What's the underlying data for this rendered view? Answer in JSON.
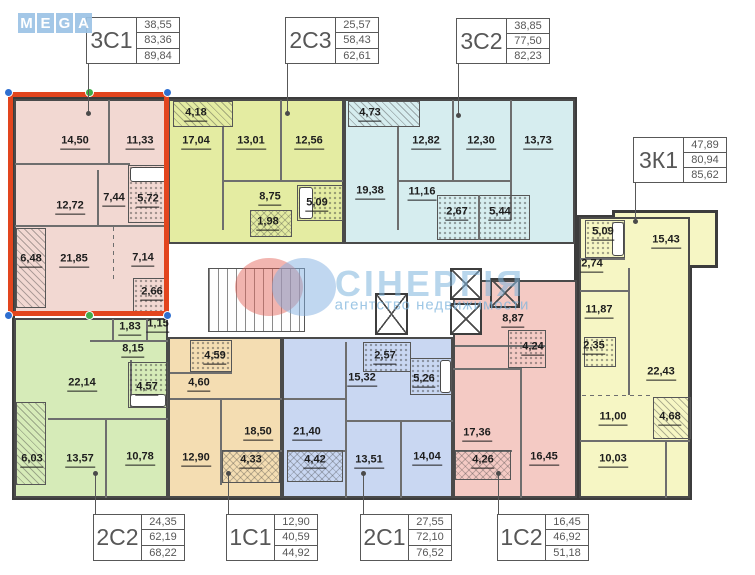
{
  "logo": {
    "letters": [
      "M",
      "E",
      "G",
      "A"
    ]
  },
  "watermark": {
    "title": "СІНЕРГІЯ",
    "subtitle": "агентство недвижимости"
  },
  "colors": {
    "highlight": "#e2451e",
    "logo_blue": "#9cc3e5",
    "unit_3c1": "#f2d8d2",
    "unit_2c3": "#e4eca2",
    "unit_3c2": "#d6edef",
    "unit_3k1": "#f6f6c4",
    "unit_2c2": "#d6ebb8",
    "unit_1c1": "#f4ddb2",
    "unit_2c1": "#c9d7f2",
    "unit_1c2": "#f4cac4"
  },
  "units": [
    {
      "code": "3С1",
      "stats": [
        "38,55",
        "83,36",
        "89,84"
      ],
      "highlighted": true,
      "rooms": [
        "14,50",
        "11,33",
        "12,72",
        "7,44",
        "5,72",
        "6,48",
        "21,85",
        "7,14",
        "2,66"
      ]
    },
    {
      "code": "2С3",
      "stats": [
        "25,57",
        "58,43",
        "62,61"
      ],
      "highlighted": false,
      "rooms": [
        "4,18",
        "17,04",
        "13,01",
        "12,56",
        "8,75",
        "1,98",
        "5,09"
      ]
    },
    {
      "code": "3С2",
      "stats": [
        "38,85",
        "77,50",
        "82,23"
      ],
      "highlighted": false,
      "rooms": [
        "4,73",
        "12,82",
        "12,30",
        "13,73",
        "19,38",
        "11,16",
        "2,67",
        "5,44"
      ]
    },
    {
      "code": "3К1",
      "stats": [
        "47,89",
        "80,94",
        "85,62"
      ],
      "highlighted": false,
      "rooms": [
        "5,09",
        "2,74",
        "15,43",
        "11,87",
        "2,35",
        "22,43",
        "11,00",
        "4,68",
        "10,03"
      ]
    },
    {
      "code": "2С2",
      "stats": [
        "24,35",
        "62,19",
        "68,22"
      ],
      "highlighted": false,
      "rooms": [
        "1,83",
        "1,15",
        "8,15",
        "22,14",
        "4,57",
        "6,03",
        "13,57",
        "10,78"
      ]
    },
    {
      "code": "1С1",
      "stats": [
        "12,90",
        "40,59",
        "44,92"
      ],
      "highlighted": false,
      "rooms": [
        "4,59",
        "4,60",
        "18,50",
        "12,90",
        "4,33"
      ]
    },
    {
      "code": "2С1",
      "stats": [
        "27,55",
        "72,10",
        "76,52"
      ],
      "highlighted": false,
      "rooms": [
        "2,57",
        "15,32",
        "5,26",
        "21,40",
        "4,42",
        "13,51",
        "14,04"
      ]
    },
    {
      "code": "1С2",
      "stats": [
        "16,45",
        "46,92",
        "51,18"
      ],
      "highlighted": false,
      "rooms": [
        "8,87",
        "4,24",
        "17,36",
        "4,26",
        "16,45"
      ]
    }
  ]
}
